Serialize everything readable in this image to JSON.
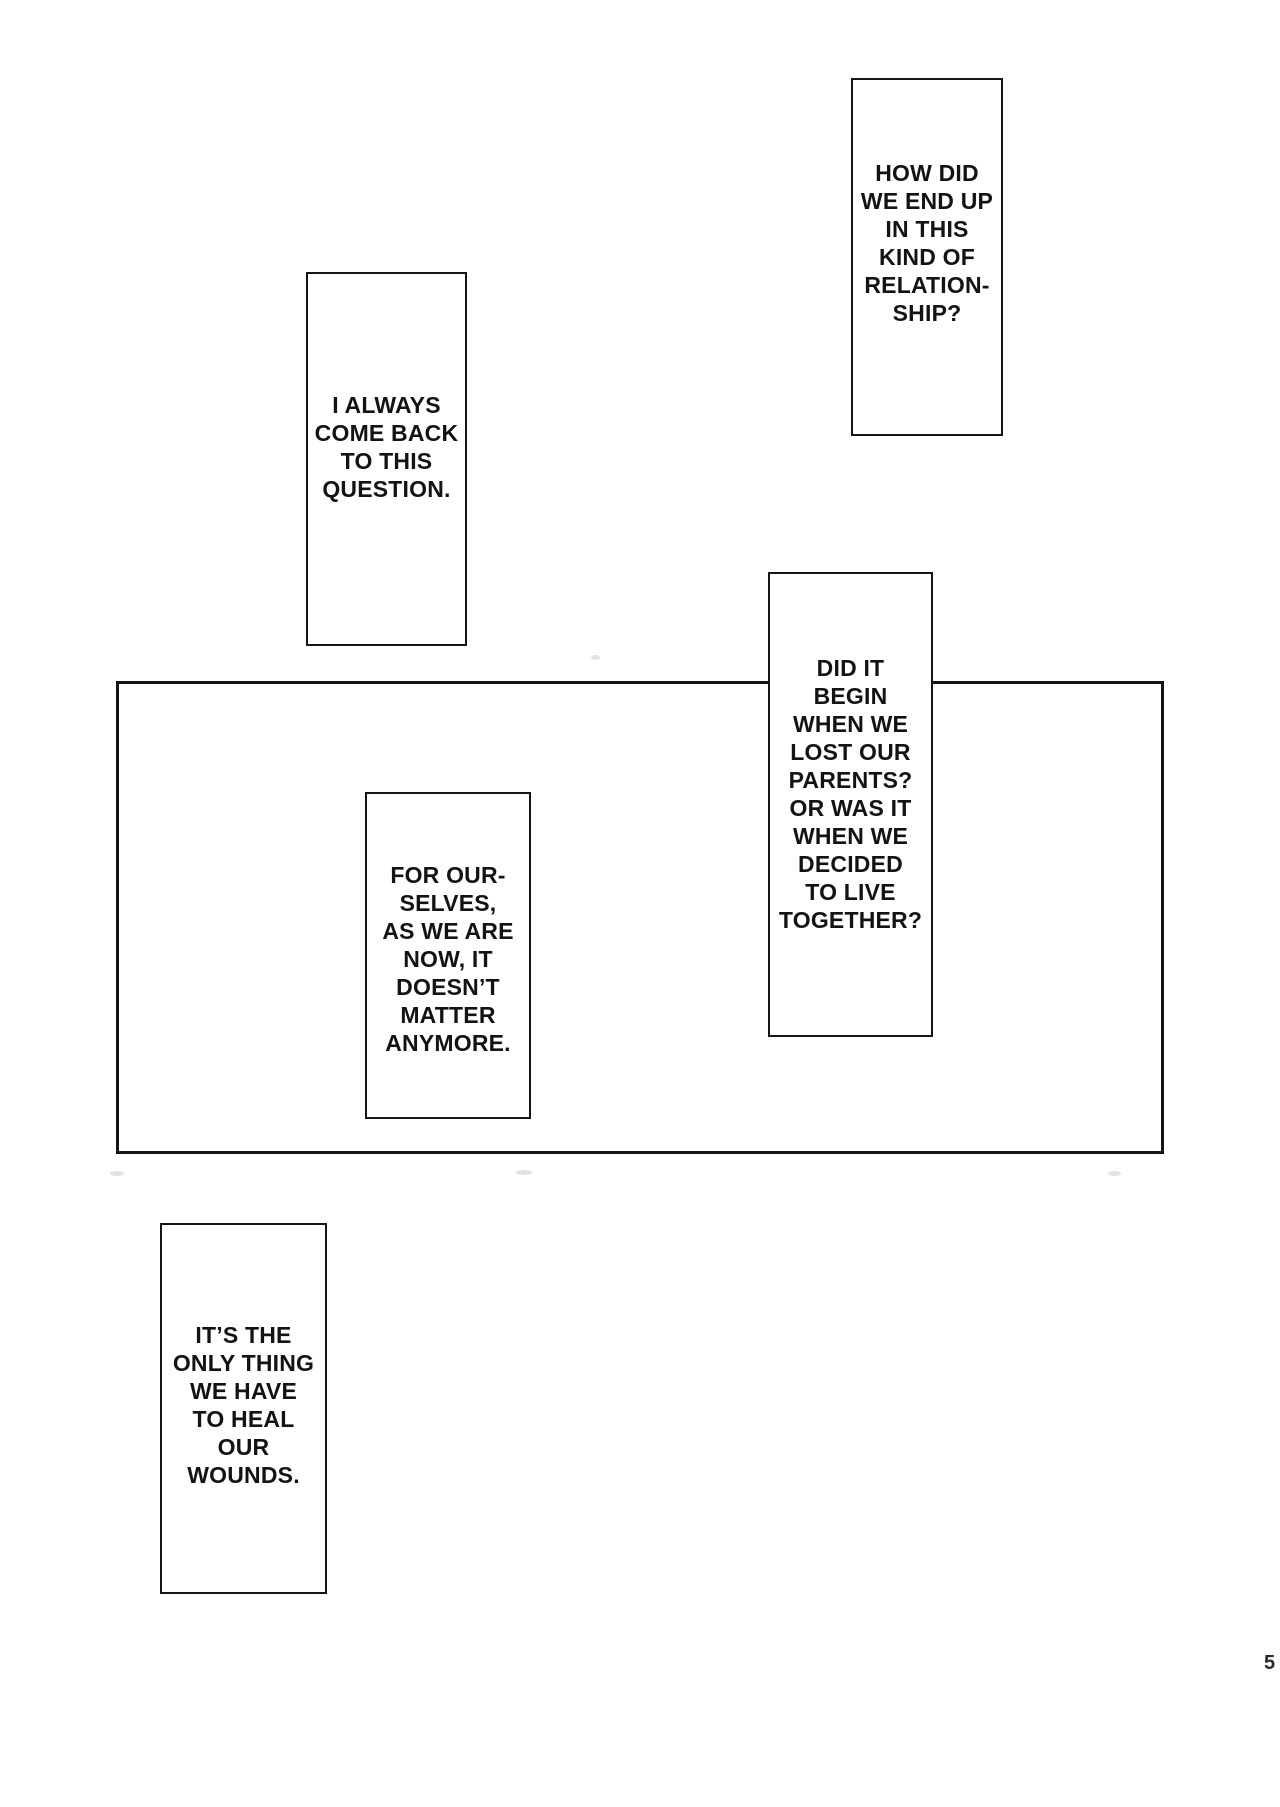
{
  "page": {
    "type": "manga-page",
    "page_number": "5"
  },
  "colors": {
    "paper": "#ffffff",
    "ink": "#151515",
    "text": "#131313",
    "page_number": "#2b2b2b"
  },
  "balloons": {
    "how_did": {
      "text": "HOW DID\nWE END UP\nIN THIS\nKIND OF\nRELATION-\nSHIP?"
    },
    "i_always": {
      "text": "I ALWAYS\nCOME BACK\nTO THIS\nQUESTION."
    },
    "did_it": {
      "text": "DID IT\nBEGIN\nWHEN WE\nLOST OUR\nPARENTS?\nOR WAS IT\nWHEN WE\nDECIDED\nTO LIVE\nTOGETHER?"
    },
    "for_ourselves": {
      "text": "FOR OUR-\nSELVES,\nAS WE ARE\nNOW, IT\nDOESN’T\nMATTER\nANYMORE."
    },
    "its_the": {
      "text": "IT’S THE\nONLY THING\nWE HAVE\nTO HEAL\nOUR\nWOUNDS."
    }
  }
}
